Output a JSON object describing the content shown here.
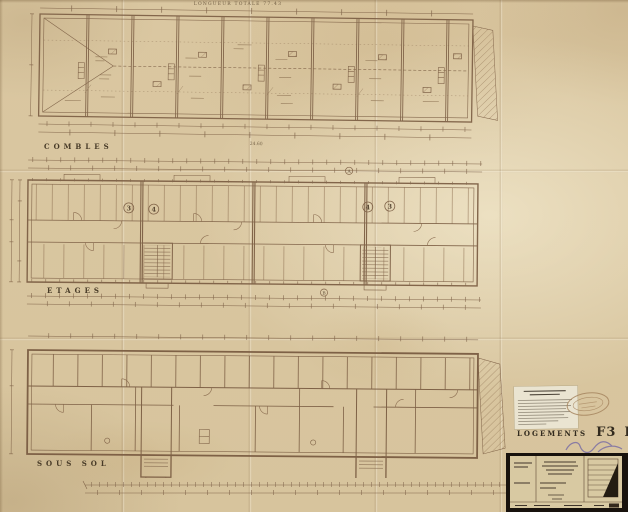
{
  "header": {
    "top_title": "LONGUEUR TOTALE 77.43"
  },
  "plans": {
    "combles": {
      "label": "COMBLES"
    },
    "etages": {
      "label": "ETAGES",
      "unit_badges": [
        "3",
        "4",
        "4",
        "3"
      ],
      "section_markers": {
        "top": "A",
        "bottom": "B"
      }
    },
    "sous_sol": {
      "label": "SOUS SOL"
    }
  },
  "dimensions": {
    "total_length": "77.43",
    "building_width": "24.60"
  },
  "annotations": {
    "logements": {
      "label": "LOGEMENTS",
      "types": [
        "F3",
        "F4",
        "F4",
        "F3"
      ]
    },
    "icons": {
      "stamp": "oval-ink-stamp",
      "scribble": "handwritten-ink-annotation",
      "note": "typed-paper-note",
      "title_block": "drawing-cartouche"
    }
  },
  "colors": {
    "paper": "#d9c6a0",
    "ink": "#7a5c42",
    "label_ink": "#473a27",
    "cartouche_frame": "#18120d",
    "stamp_ink": "#a6855f",
    "pen_ink": "#6f63a6"
  }
}
